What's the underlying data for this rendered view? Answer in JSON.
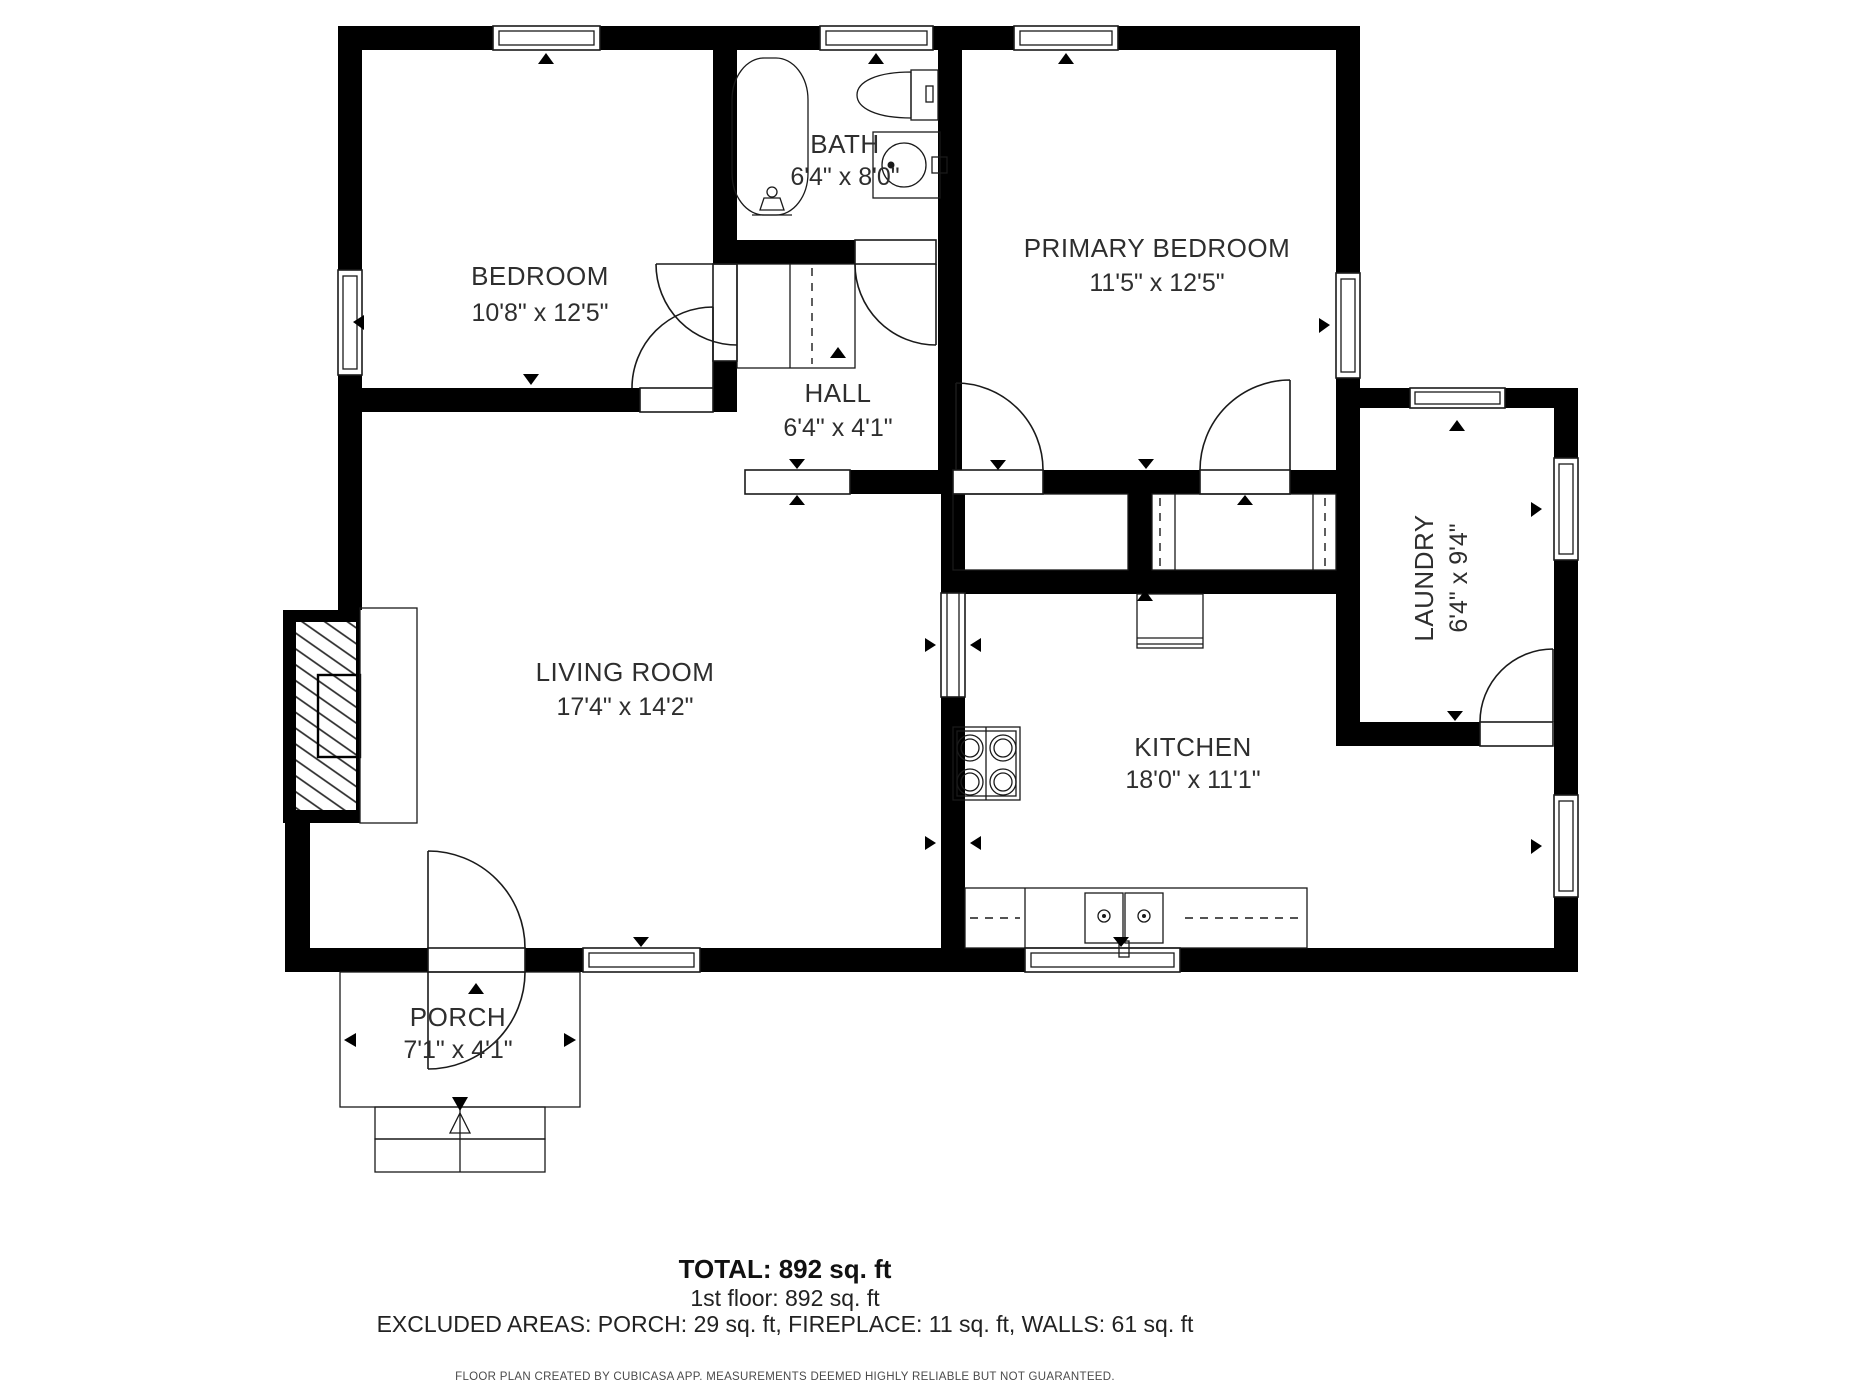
{
  "plan": {
    "rooms": [
      {
        "name": "BEDROOM",
        "dims": "10'8\" x 12'5\""
      },
      {
        "name": "BATH",
        "dims": "6'4\" x 8'0\""
      },
      {
        "name": "PRIMARY BEDROOM",
        "dims": "11'5\" x 12'5\""
      },
      {
        "name": "HALL",
        "dims": "6'4\" x 4'1\""
      },
      {
        "name": "LAUNDRY",
        "dims": "6'4\" x 9'4\""
      },
      {
        "name": "LIVING ROOM",
        "dims": "17'4\" x 14'2\""
      },
      {
        "name": "KITCHEN",
        "dims": "18'0\" x 11'1\""
      },
      {
        "name": "PORCH",
        "dims": "7'1\" x 4'1\""
      }
    ],
    "summary": {
      "total": "TOTAL: 892 sq. ft",
      "floor1": "1st floor: 892 sq. ft",
      "excluded": "EXCLUDED AREAS: PORCH: 29 sq. ft, FIREPLACE: 11 sq. ft, WALLS: 61 sq. ft",
      "footer": "FLOOR PLAN CREATED BY CUBICASA APP. MEASUREMENTS DEEMED HIGHLY RELIABLE BUT NOT GUARANTEED."
    },
    "colors": {
      "wall": "#000000",
      "text": "#2e2e2e",
      "background": "#ffffff"
    }
  }
}
